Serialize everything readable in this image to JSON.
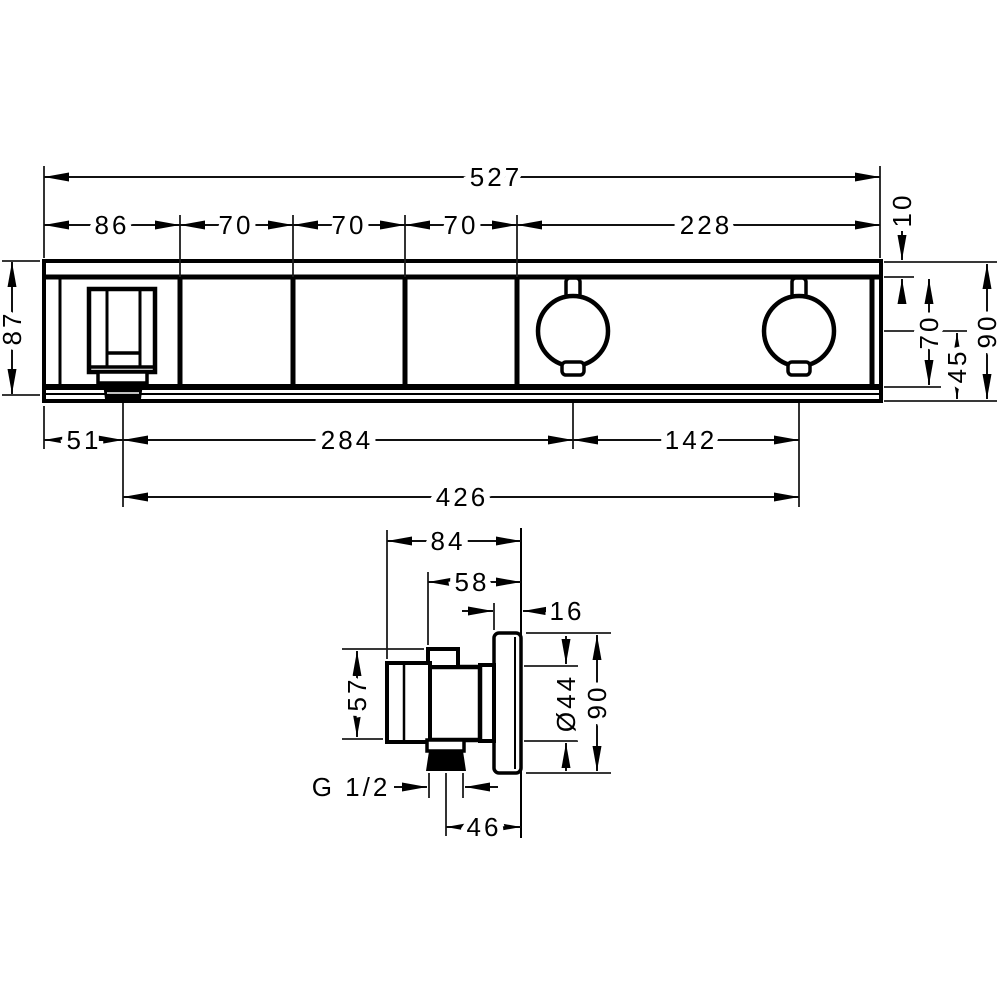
{
  "colors": {
    "line": "#000000",
    "background": "#ffffff"
  },
  "front_view": {
    "dims": {
      "total_width": "527",
      "segment_86": "86",
      "segment_70a": "70",
      "segment_70b": "70",
      "segment_70c": "70",
      "segment_228": "228",
      "height_87": "87",
      "top_inset_10": "10",
      "inner_height_70": "70",
      "center_to_bottom_45": "45",
      "total_height_90": "90",
      "outlet_from_left_51": "51",
      "outlet_to_knob1_284": "284",
      "knob_spacing_142": "142",
      "outlet_to_knob2_426": "426"
    }
  },
  "side_view": {
    "dims": {
      "total_depth_84": "84",
      "body_depth_58": "58",
      "escutcheon_depth_16": "16",
      "body_height_57": "57",
      "escutcheon_dia_44": "Ø44",
      "escutcheon_height_90": "90",
      "thread_size": "G 1/2",
      "outlet_to_wall_46": "46"
    }
  }
}
